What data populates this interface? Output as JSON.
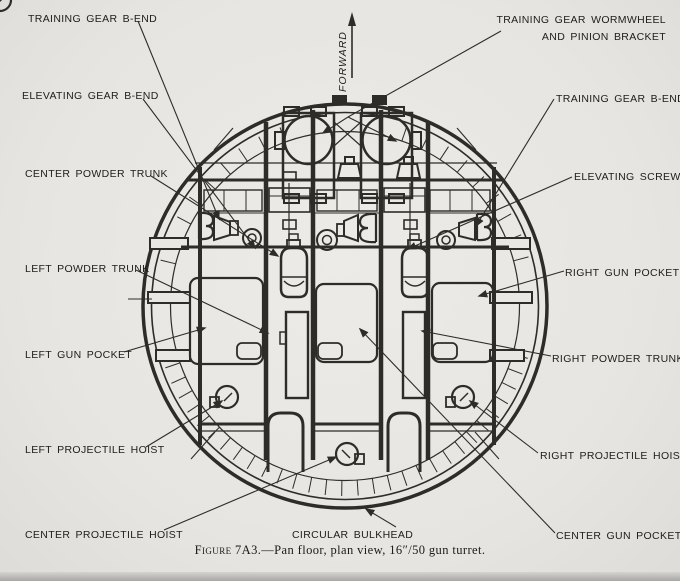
{
  "colors": {
    "paper": "#e9e7e3",
    "ink": "#2e2c29"
  },
  "labels": {
    "training_gear_b_end_left": "TRAINING GEAR B-END",
    "training_gear_wormwheel_line1": "TRAINING GEAR WORMWHEEL",
    "training_gear_wormwheel_line2": "AND PINION BRACKET",
    "training_gear_b_end_right": "TRAINING GEAR B-END",
    "elevating_gear_b_end": "ELEVATING GEAR B-END",
    "elevating_screw": "ELEVATING SCREW",
    "center_powder_trunk": "CENTER POWDER TRUNK",
    "right_gun_pocket": "RIGHT GUN POCKET",
    "left_powder_trunk": "LEFT POWDER TRUNK",
    "right_powder_trunk": "RIGHT POWDER TRUNK",
    "left_gun_pocket": "LEFT GUN POCKET",
    "left_projectile_hoist": "LEFT PROJECTILE HOIST",
    "right_projectile_hoist": "RIGHT PROJECTILE HOIST",
    "center_projectile_hoist": "CENTER PROJECTILE HOIST",
    "circular_bulkhead": "CIRCULAR BULKHEAD",
    "center_gun_pocket": "CENTER GUN POCKET",
    "forward": "FORWARD"
  },
  "caption": {
    "figure": "Figure 7A3.",
    "rest": "—Pan floor, plan view, 16″/50 gun turret."
  }
}
